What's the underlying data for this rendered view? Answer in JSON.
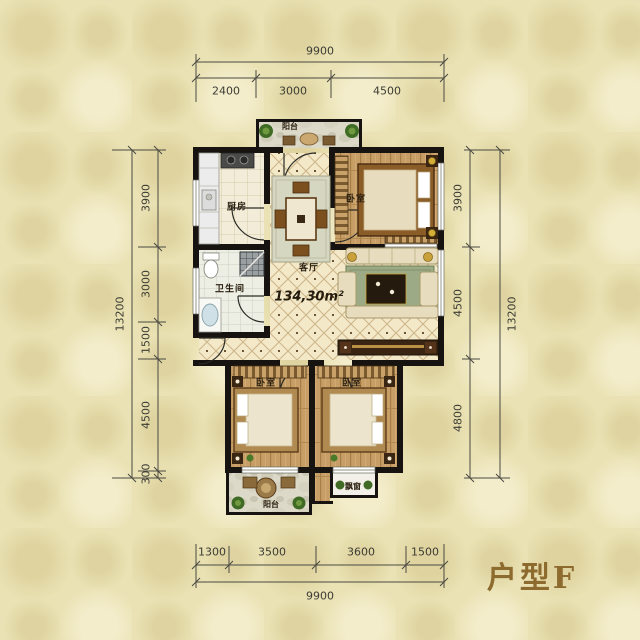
{
  "title": {
    "text": "户型F"
  },
  "plan": {
    "area_label": "134,30m²",
    "rooms": {
      "living": "客厅",
      "kitchen": "厨房",
      "bathroom": "卫生间",
      "bedroom_master": "卧室",
      "bedroom_left": "卧室",
      "bedroom_right": "卧室",
      "balcony_top": "阳台",
      "balcony_bottom": "阳台",
      "bay_window": "飘窗"
    }
  },
  "dimensions": {
    "top": {
      "total": "9900",
      "segments": [
        "2400",
        "3000",
        "4500"
      ]
    },
    "bottom": {
      "total": "9900",
      "segments": [
        "1300",
        "3500",
        "3600",
        "1500"
      ]
    },
    "left": {
      "total": "13200",
      "segments": [
        "3900",
        "3000",
        "1500",
        "4500",
        "300"
      ]
    },
    "right": {
      "total": "13200",
      "segments": [
        "3900",
        "4500",
        "4800"
      ]
    }
  },
  "colors": {
    "wall": "#171310",
    "title_accent": "#8d6a2e",
    "wood_floor": "#c69e66",
    "tile_floor": "#f3e9c8"
  }
}
